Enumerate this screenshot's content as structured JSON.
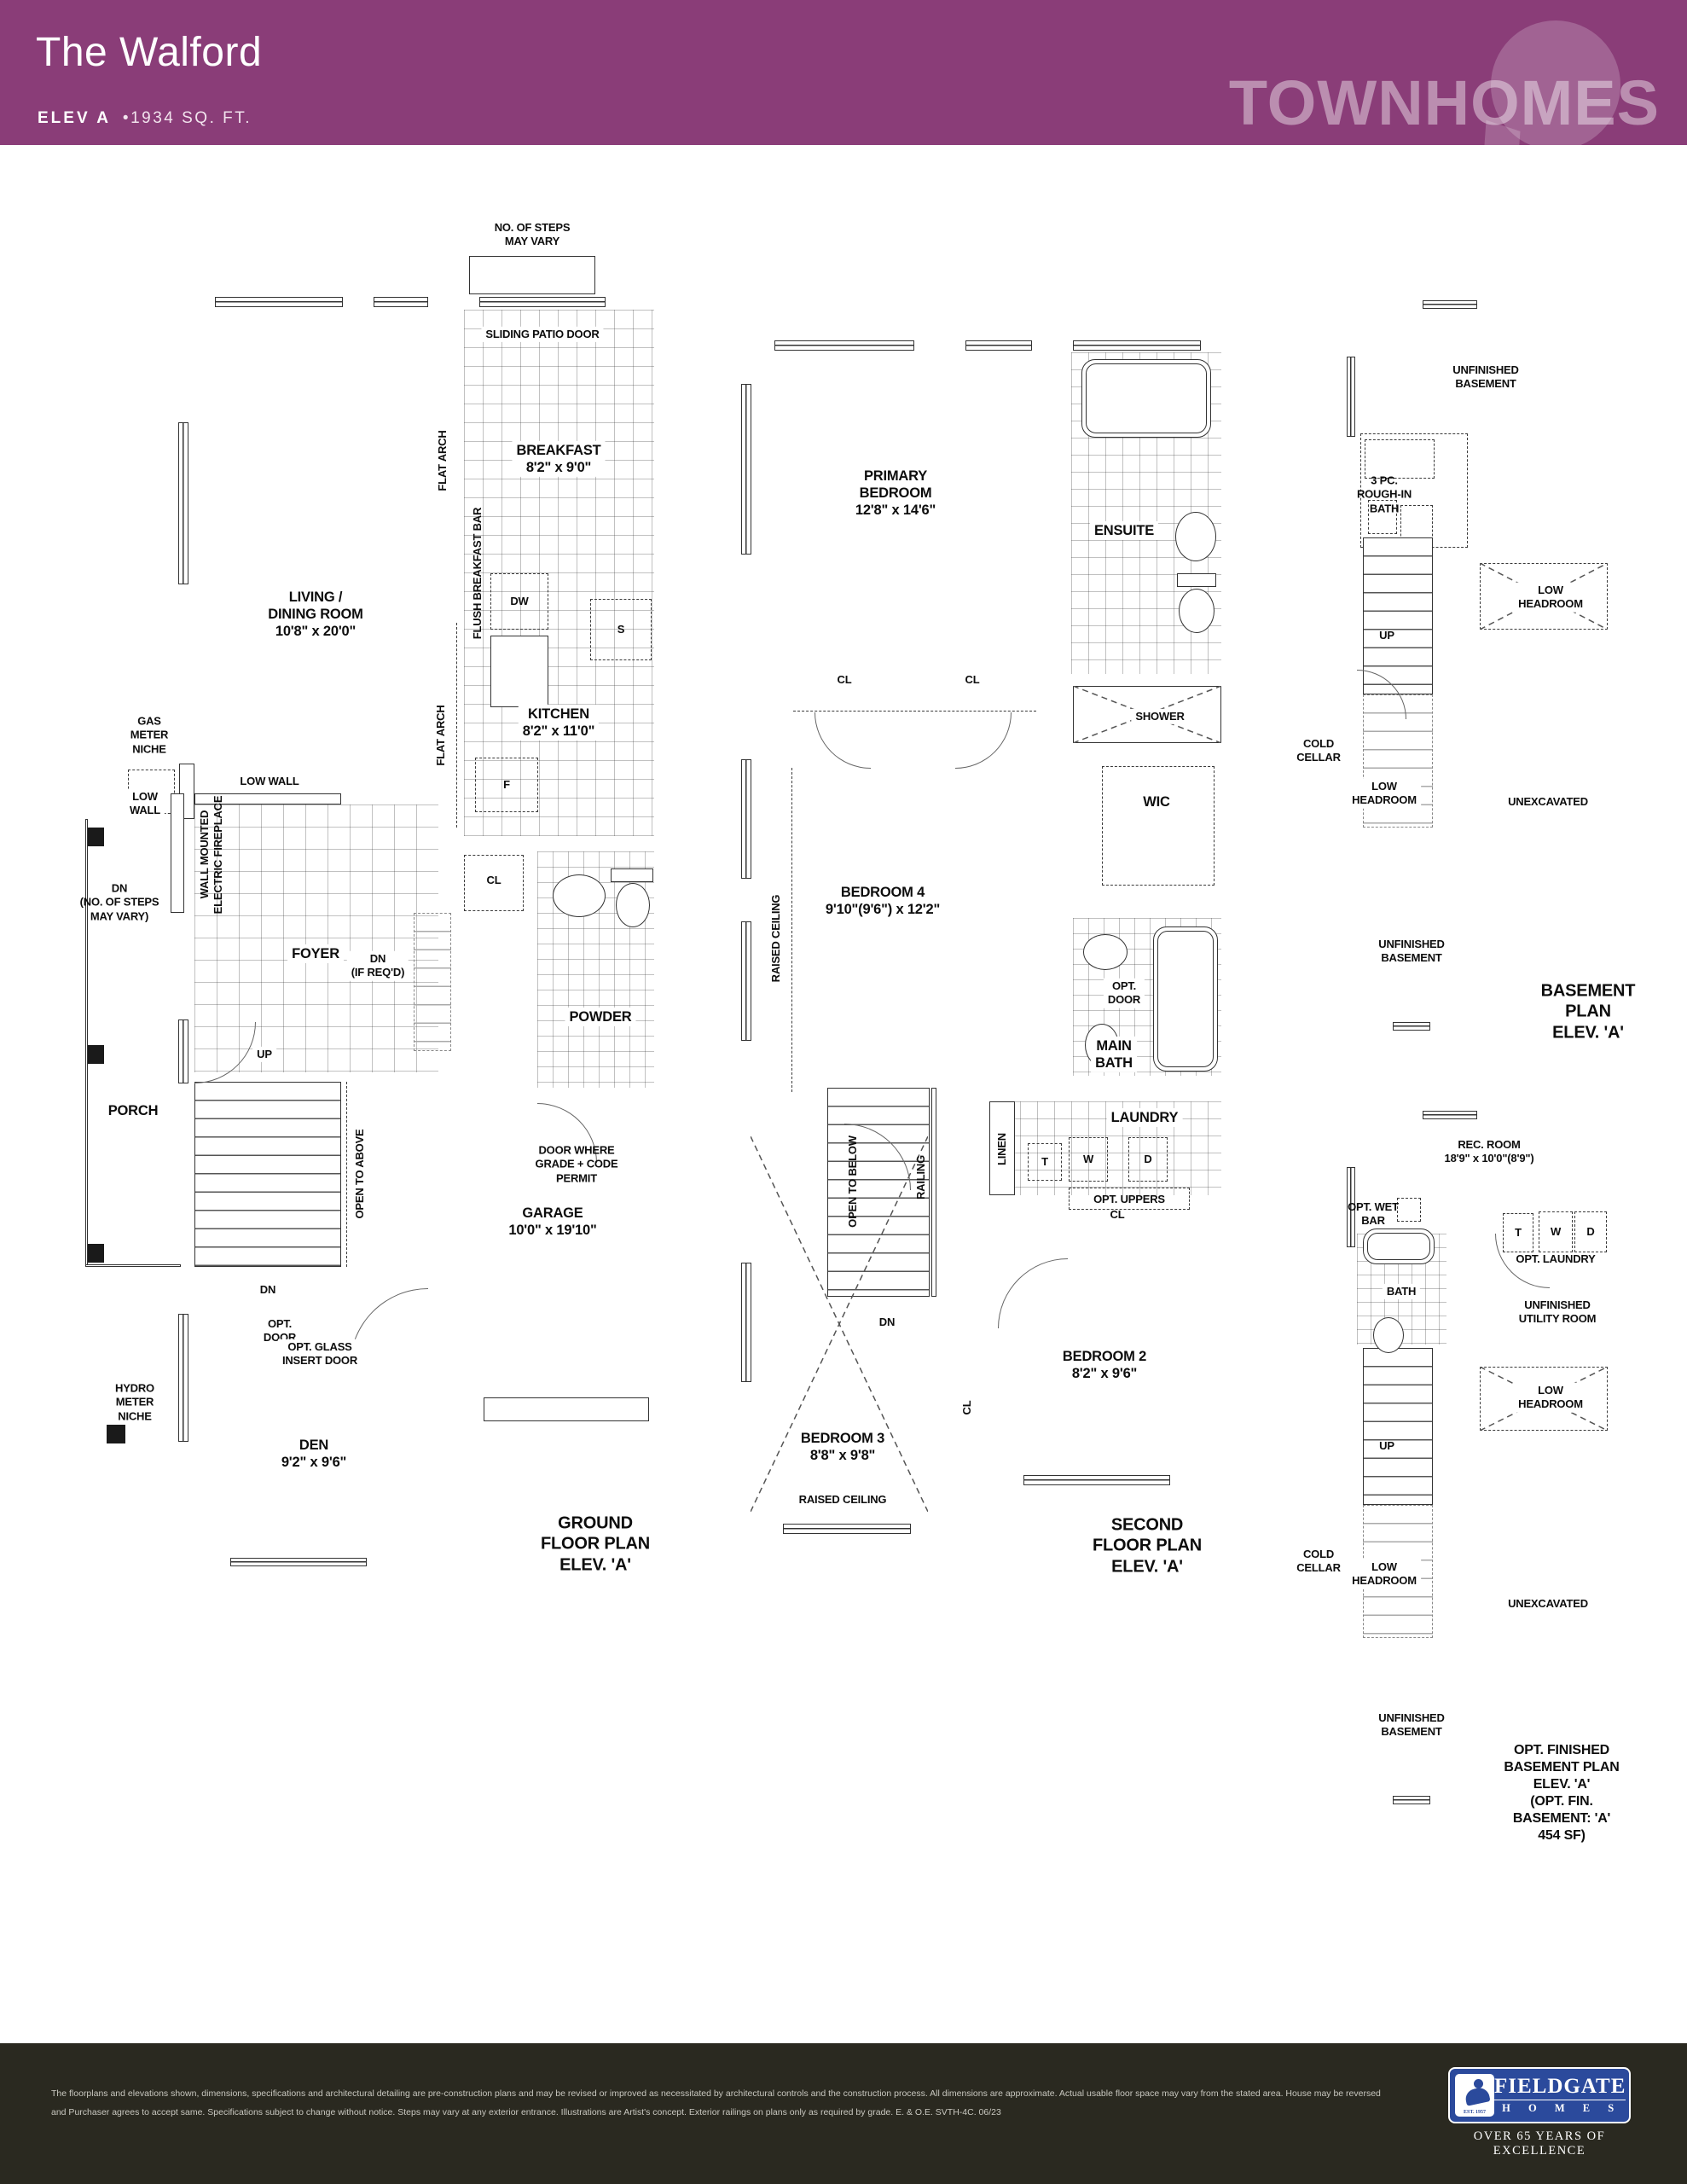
{
  "header": {
    "title": "The Walford",
    "elev": "ELEV A",
    "sqft": "•1934 SQ. FT.",
    "brand": "TOWNHOMES",
    "colors": {
      "bg": "#8a3d78",
      "bubble": "rgba(255,255,255,0.2)",
      "brand_text": "rgba(255,255,255,0.42)"
    }
  },
  "plans": {
    "ground": {
      "labels": {
        "steps_note": "NO. OF STEPS\nMAY VARY",
        "sliding_patio_door": "SLIDING PATIO DOOR",
        "breakfast": "BREAKFAST\n8'2\" x 9'0\"",
        "flat_arch": "FLAT ARCH",
        "living": "LIVING /\nDINING ROOM\n10'8\" x 20'0\"",
        "fireplace": "WALL MOUNTED\nELECTRIC FIREPLACE",
        "flush_bar": "FLUSH BREAKFAST BAR",
        "dw": "DW",
        "s": "S",
        "f": "F",
        "kitchen": "KITCHEN\n8'2\" x 11'0\"",
        "gas_meter": "GAS\nMETER\nNICHE",
        "low_wall_2line": "LOW\nWALL",
        "low_wall": "LOW WALL",
        "cl": "CL",
        "powder": "POWDER",
        "foyer": "FOYER",
        "dn_if_reqd": "DN\n(IF REQ'D)",
        "dn_steps": "DN\n(NO. OF STEPS\nMAY VARY)",
        "up": "UP",
        "door_grade": "DOOR WHERE\nGRADE + CODE\nPERMIT",
        "porch": "PORCH",
        "open_to_above": "OPEN TO ABOVE",
        "dn": "DN",
        "opt_door": "OPT.\nDOOR",
        "garage": "GARAGE\n10'0\" x 19'10\"",
        "opt_glass": "OPT. GLASS\nINSERT DOOR",
        "hydro_meter": "HYDRO\nMETER\nNICHE",
        "den": "DEN\n9'2\" x 9'6\"",
        "caption": "GROUND FLOOR PLAN\nELEV. 'A'"
      }
    },
    "second": {
      "labels": {
        "primary": "PRIMARY\nBEDROOM\n12'8\" x 14'6\"",
        "ensuite": "ENSUITE",
        "shower": "SHOWER",
        "cl": "CL",
        "wic": "WIC",
        "bedroom4": "BEDROOM 4\n9'10\"(9'6\") x 12'2\"",
        "raised_ceiling": "RAISED CEILING",
        "opt_door": "OPT.\nDOOR",
        "main_bath": "MAIN\nBATH",
        "laundry": "LAUNDRY",
        "linen": "LINEN",
        "t": "T",
        "w": "W",
        "d": "D",
        "opt_uppers": "OPT. UPPERS",
        "open_to_below": "OPEN TO BELOW",
        "railing": "RAILING",
        "dn": "DN",
        "bedroom2": "BEDROOM 2\n8'2\" x 9'6\"",
        "bedroom3": "BEDROOM 3\n8'8\" x 9'8\"",
        "caption": "SECOND FLOOR PLAN\nELEV. 'A'"
      }
    },
    "basement": {
      "labels": {
        "unfinished": "UNFINISHED\nBASEMENT",
        "rough_in": "3 PC.\nROUGH-IN\nBATH",
        "low_headroom": "LOW\nHEADROOM",
        "up": "UP",
        "cold_cellar": "COLD\nCELLAR",
        "unexcavated": "UNEXCAVATED",
        "unfinished2": "UNFINISHED\nBASEMENT",
        "caption": "BASEMENT PLAN\nELEV. 'A'"
      }
    },
    "opt_basement": {
      "labels": {
        "rec_room": "REC. ROOM\n18'9\" x 10'0\"(8'9\")",
        "opt_wet_bar": "OPT. WET\nBAR",
        "bath": "BATH",
        "t": "T",
        "w": "W",
        "d": "D",
        "opt_laundry": "OPT. LAUNDRY",
        "utility": "UNFINISHED\nUTILITY ROOM",
        "low_headroom": "LOW\nHEADROOM",
        "up": "UP",
        "cold_cellar": "COLD\nCELLAR",
        "unexcavated": "UNEXCAVATED",
        "unfinished": "UNFINISHED\nBASEMENT",
        "caption": "OPT. FINISHED BASEMENT PLAN\nELEV. 'A'\n(OPT. FIN. BASEMENT: 'A' 454 SF)"
      }
    }
  },
  "footer": {
    "disclaimer": "The floorplans and elevations shown, dimensions, specifications and architectural detailing are pre-construction plans and may be revised or improved as necessitated by architectural controls and the construction process.  All dimensions are approximate. Actual usable floor space may vary from the stated area. House may be reversed and Purchaser agrees to accept same. Specifications subject to change without notice. Steps may vary at any exterior entrance. Illustrations are Artist's concept. Exterior railings on plans only as required by grade. E. & O.E. SVTH-4C. 06/23",
    "logo": {
      "name": "FIELDGATE",
      "homes": "H O M E S",
      "est": "EST. 1957",
      "tagline": "OVER 65 YEARS OF EXCELLENCE"
    },
    "colors": {
      "bg": "#2a2920",
      "logo_blue": "#2b4a9c"
    }
  }
}
